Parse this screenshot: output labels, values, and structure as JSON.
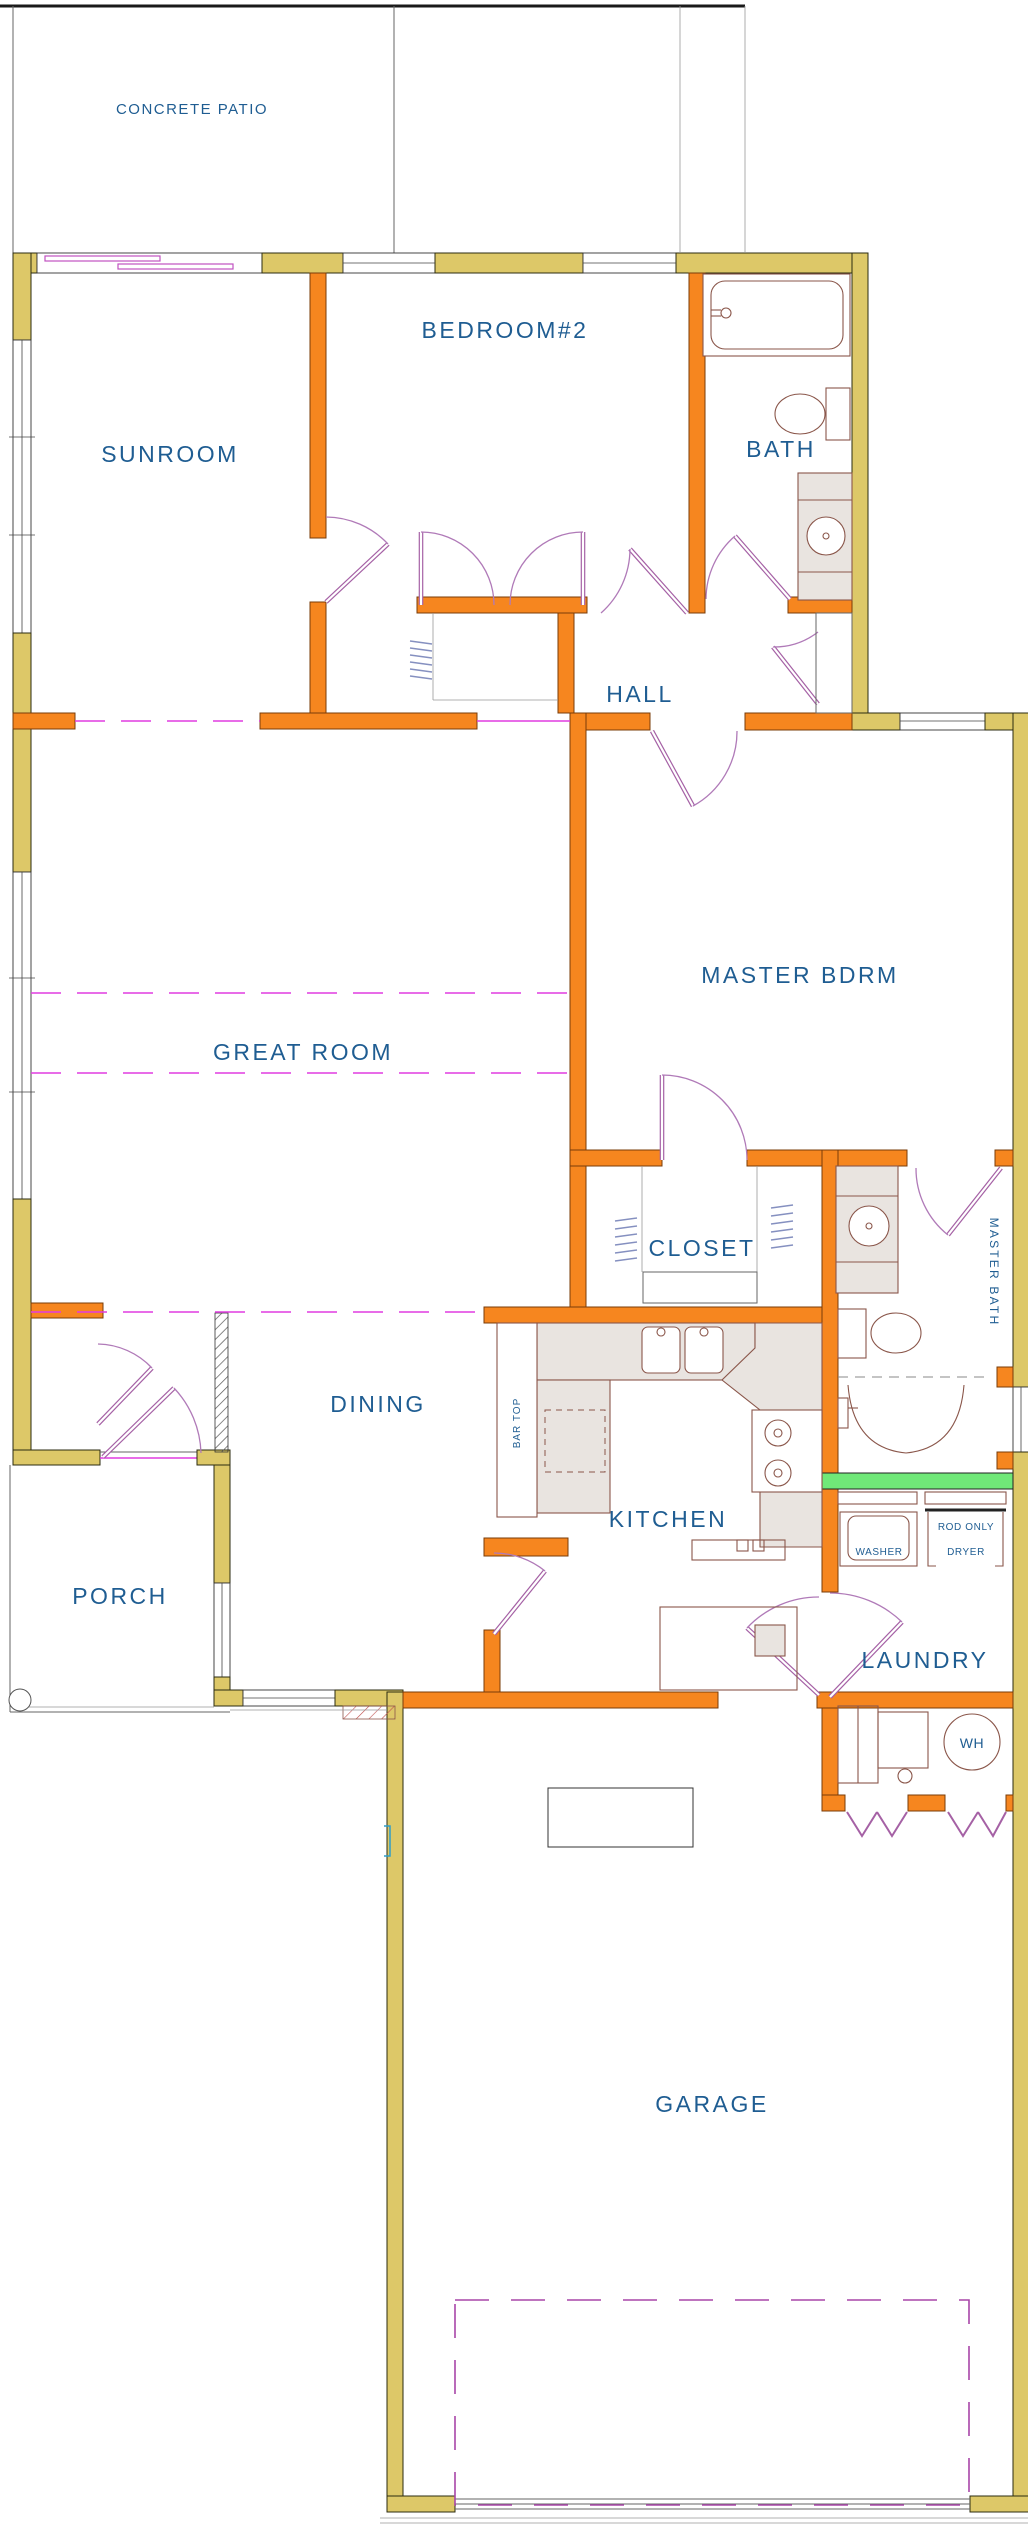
{
  "labels": {
    "patio": "CONCRETE PATIO",
    "sunroom": "SUNROOM",
    "bedroom2": "BEDROOM#2",
    "bath": "BATH",
    "hall": "HALL",
    "great_room": "GREAT ROOM",
    "master_bdrm": "MASTER BDRM",
    "closet": "CLOSET",
    "master_bath": "MASTER BATH",
    "dining": "DINING",
    "bar_top": "BAR TOP",
    "kitchen": "KITCHEN",
    "porch": "PORCH",
    "laundry": "LAUNDRY",
    "washer": "WASHER",
    "dryer": "DRYER",
    "rod_only": "ROD ONLY",
    "water_heater": "WH",
    "garage": "GARAGE"
  },
  "colors": {
    "exterior_wall": "#ddc868",
    "interior_wall": "#f6861f",
    "accent_wall_green": "#70e878",
    "room_label_text": "#1f5d92",
    "door_swing": "#a561a5",
    "ceiling_break_dash": "#e13ce1",
    "fixture_fill": "#e9e4e0"
  }
}
